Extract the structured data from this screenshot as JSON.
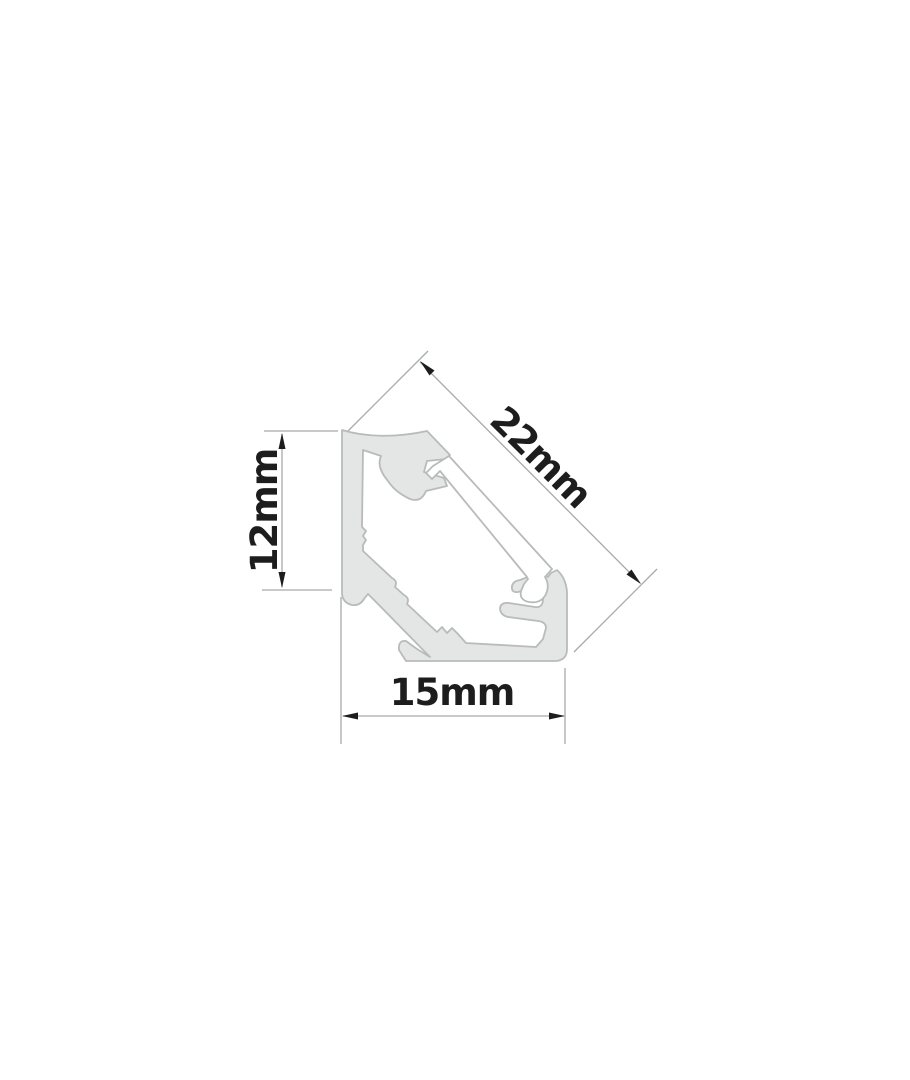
{
  "diagram": {
    "labels": {
      "diagonal": "22mm",
      "height": "12mm",
      "width": "15mm"
    },
    "colors": {
      "bg": "#ffffff",
      "profile_fill": "#e4e5e5",
      "profile_outline": "#b9bbbb",
      "dim": "#a5abab",
      "arrow": "#1d1d1d",
      "label": "#1d1d1d"
    }
  }
}
